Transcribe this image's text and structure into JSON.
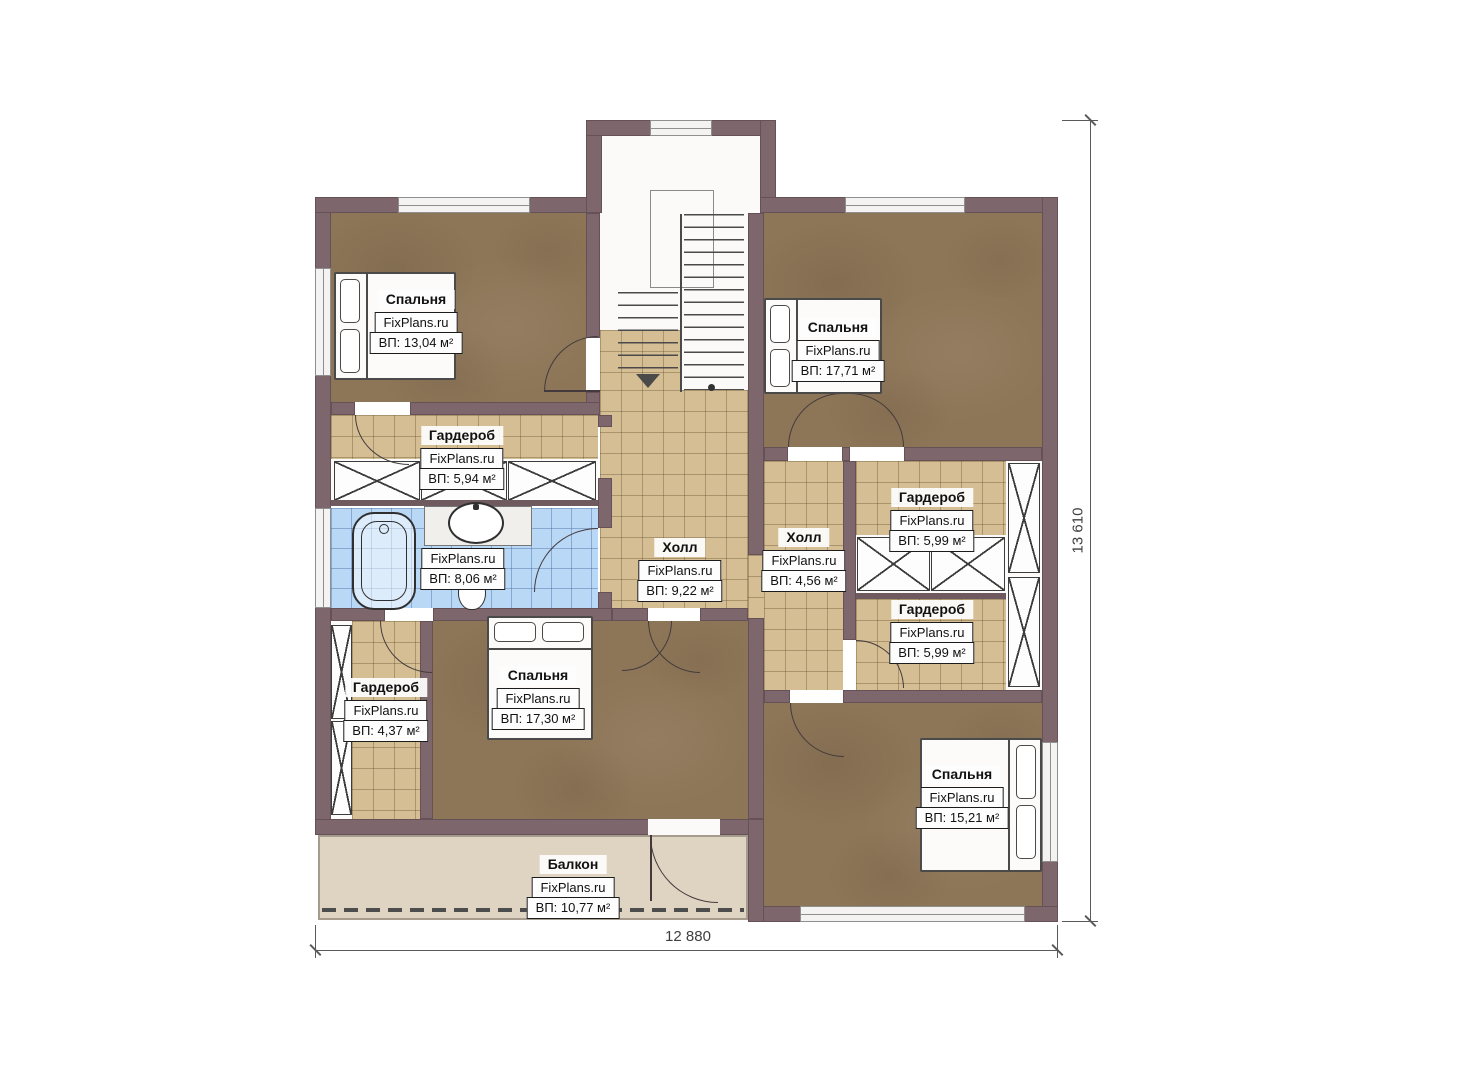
{
  "plan": {
    "watermark": "FixPlans.ru",
    "rooms": [
      {
        "id": "bedroom-top-left",
        "name": "Спальня",
        "area": "ВП: 13,04 м²"
      },
      {
        "id": "bedroom-top-right",
        "name": "Спальня",
        "area": "ВП: 17,71 м²"
      },
      {
        "id": "wardrobe-left",
        "name": "Гардероб",
        "area": "ВП: 5,94 м²"
      },
      {
        "id": "bathroom",
        "name": "С/у",
        "area": "ВП: 8,06 м²"
      },
      {
        "id": "hall-center",
        "name": "Холл",
        "area": "ВП: 9,22 м²"
      },
      {
        "id": "hall-right",
        "name": "Холл",
        "area": "ВП: 4,56 м²"
      },
      {
        "id": "wardrobe-right-upper",
        "name": "Гардероб",
        "area": "ВП: 5,99 м²"
      },
      {
        "id": "wardrobe-right-lower",
        "name": "Гардероб",
        "area": "ВП: 5,99 м²"
      },
      {
        "id": "wardrobe-bottom-left",
        "name": "Гардероб",
        "area": "ВП: 4,37 м²"
      },
      {
        "id": "bedroom-bottom-center",
        "name": "Спальня",
        "area": "ВП: 17,30 м²"
      },
      {
        "id": "bedroom-bottom-right",
        "name": "Спальня",
        "area": "ВП: 15,21 м²"
      },
      {
        "id": "balcony",
        "name": "Балкон",
        "area": "ВП: 10,77 м²"
      }
    ],
    "dimensions": {
      "width_label": "12 880",
      "height_label": "13 610"
    },
    "colors": {
      "wall": "#7d666c",
      "floor_wood": "#8d7557",
      "floor_tile": "#d5be94",
      "floor_bath": "#b9d8f6",
      "floor_balcony": "#ded4c1"
    }
  }
}
